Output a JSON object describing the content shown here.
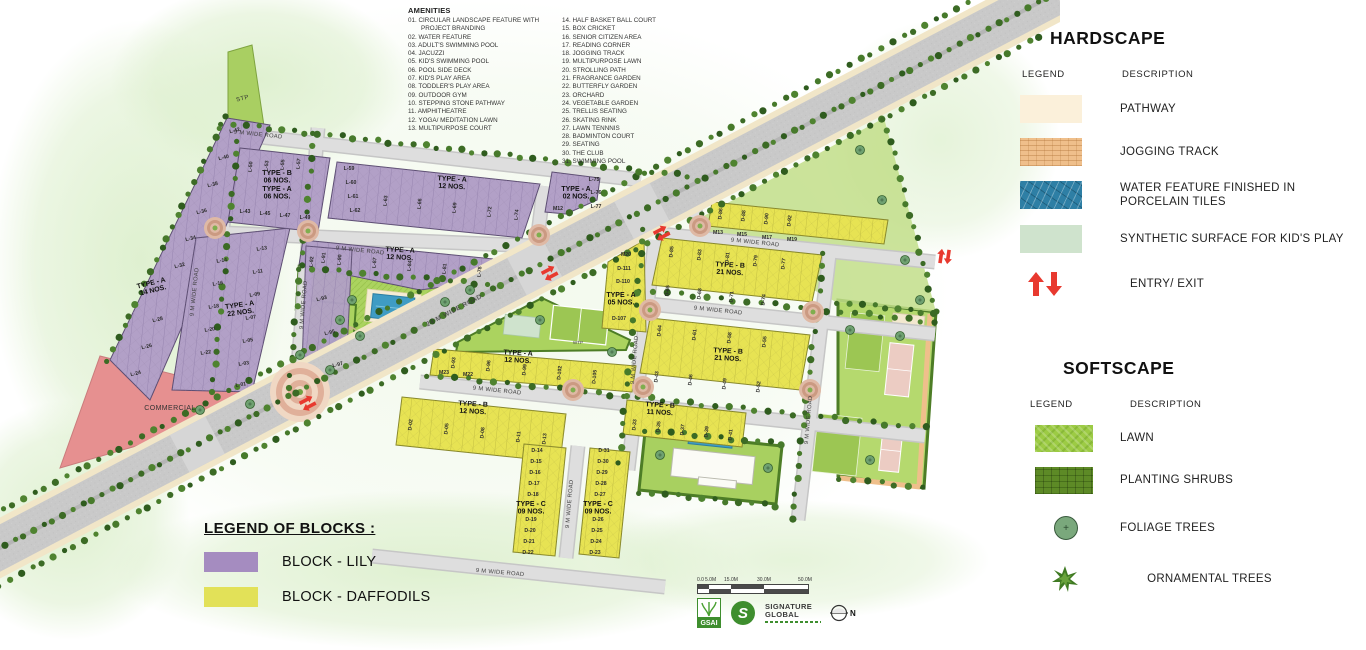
{
  "amenities": {
    "title": "AMENITIES",
    "col1": [
      "01. CIRCULAR LANDSCAPE FEATURE WITH PROJECT BRANDING",
      "02. WATER FEATURE",
      "03. ADULT'S SWIMMING POOL",
      "04. JACUZZI",
      "05. KID'S SWIMMING POOL",
      "06. POOL SIDE DECK",
      "07. KID'S PLAY AREA",
      "08. TODDLER'S PLAY AREA",
      "09. OUTDOOR GYM",
      "10. STEPPING STONE PATHWAY",
      "11. AMPHITHEATRE",
      "12. YOGA/ MEDITATION LAWN",
      "13. MULTIPURPOSE COURT"
    ],
    "col2": [
      "14. HALF BASKET BALL COURT",
      "15. BOX CRICKET",
      "16. SENIOR CITIZEN AREA",
      "17. READING CORNER",
      "18. JOGGING TRACK",
      "19. MULTIPURPOSE LAWN",
      "20. STROLLING PATH",
      "21. FRAGRANCE GARDEN",
      "22. BUTTERFLY GARDEN",
      "23. ORCHARD",
      "24. VEGETABLE GARDEN",
      "25. TRELLIS SEATING",
      "26. SKATING RINK",
      "27. LAWN TENNNIS",
      "28. BADMINTON COURT",
      "29. SEATING",
      "30. THE CLUB",
      "31. SWIMMING POOL"
    ]
  },
  "hardscape": {
    "title": "HARDSCAPE",
    "legend_header": "LEGEND",
    "description_header": "DESCRIPTION",
    "items": [
      {
        "label": "PATHWAY",
        "color": "#fbf0da"
      },
      {
        "label": "JOGGING TRACK",
        "color": "#efbf8b"
      },
      {
        "label": "WATER FEATURE FINISHED IN PORCELAIN TILES",
        "color": "#2e7fa5"
      },
      {
        "label": "SYNTHETIC SURFACE FOR KID'S PLAY",
        "color": "#cfe3cd"
      },
      {
        "label": "ENTRY/ EXIT",
        "color": "#e8392f"
      }
    ]
  },
  "softscape": {
    "title": "SOFTSCAPE",
    "legend_header": "LEGEND",
    "description_header": "DESCRIPTION",
    "items": [
      {
        "label": "LAWN",
        "color": "#9ccb44"
      },
      {
        "label": "PLANTING SHRUBS",
        "color": "#5d8a26"
      },
      {
        "label": "FOLIAGE TREES",
        "color": "#7aa87c"
      },
      {
        "label": "ORNAMENTAL TREES",
        "color": "#3f7a22"
      }
    ]
  },
  "blocks_legend": {
    "title": "LEGEND OF BLOCKS :",
    "items": [
      {
        "label": "BLOCK - LILY",
        "color": "#a58cc0"
      },
      {
        "label": "BLOCK - DAFFODILS",
        "color": "#e2e158"
      }
    ]
  },
  "map": {
    "stp": "STP",
    "commercial": "COMMERCIAL",
    "wtp": "WTP",
    "main_road": "24 M WIDE ROAD",
    "road": "9 M WIDE ROAD",
    "block_labels": [
      {
        "t": "TYPE - A",
        "n": "14 NOS."
      },
      {
        "t": "TYPE - A",
        "n": "22 NOS."
      },
      {
        "t": "TYPE - B",
        "n": "06 NOS."
      },
      {
        "t": "TYPE - A",
        "n": "06 NOS."
      },
      {
        "t": "TYPE - A",
        "n": "12 NOS."
      },
      {
        "t": "TYPE - A",
        "n": "12 NOS."
      },
      {
        "t": "TYPE - A",
        "n": "02 NOS."
      },
      {
        "t": "TYPE - B",
        "n": "21 NOS."
      },
      {
        "t": "TYPE - B",
        "n": "21 NOS."
      },
      {
        "t": "TYPE - A",
        "n": "12 NOS."
      },
      {
        "t": "TYPE - A",
        "n": "05 NOS."
      },
      {
        "t": "TYPE - B",
        "n": "12 NOS."
      },
      {
        "t": "TYPE - C",
        "n": "09 NOS."
      },
      {
        "t": "TYPE - C",
        "n": "09 NOS."
      },
      {
        "t": "TYPE - B",
        "n": "11 NOS."
      }
    ],
    "plot_labels": [
      "L-42",
      "L-40",
      "L-38",
      "L-36",
      "L-34",
      "L-32",
      "L-28",
      "L-26",
      "L-24",
      "L-13",
      "L-11",
      "L-09",
      "L-07",
      "L-05",
      "L-03",
      "L-01",
      "L-14",
      "L-16",
      "L-18",
      "L-20",
      "L-22",
      "L-50",
      "L-53",
      "L-55",
      "L-57",
      "L-43",
      "L-45",
      "L-47",
      "L-49",
      "L-59",
      "L-60",
      "L-61",
      "L-62",
      "L-63",
      "L-66",
      "L-69",
      "L-72",
      "L-74",
      "L-91",
      "L-90",
      "L-87",
      "L-84",
      "L-81",
      "L-78",
      "L-92",
      "L-93",
      "L-95",
      "L-97",
      "L-75",
      "L-76",
      "L-77",
      "M12",
      "D-86",
      "D-88",
      "D-90",
      "D-92",
      "M13",
      "M15",
      "M17",
      "M19",
      "D-85",
      "D-83",
      "D-81",
      "D-79",
      "D-77",
      "D-65",
      "D-68",
      "D-71",
      "D-74",
      "D-64",
      "D-61",
      "D-58",
      "D-55",
      "D-43",
      "D-46",
      "D-49",
      "D-52",
      "M20",
      "D-111",
      "D-110",
      "D-107",
      "M23",
      "M22",
      "D-93",
      "D-96",
      "D-99",
      "D-102",
      "D-105",
      "D-02",
      "D-05",
      "D-08",
      "D-11",
      "D-13",
      "D-14",
      "D-15",
      "D-16",
      "D-17",
      "D-18",
      "D-19",
      "D-20",
      "D-21",
      "D-22",
      "D-31",
      "D-30",
      "D-29",
      "D-28",
      "D-27",
      "D-26",
      "D-25",
      "D-24",
      "D-23",
      "D-33",
      "D-35",
      "D-37",
      "D-39",
      "D-41"
    ]
  },
  "scale_bar": {
    "labels": [
      "0.0",
      "5.0M",
      "15.0M",
      "30.0M",
      "50.0M"
    ]
  },
  "logos": {
    "gsai": "GSAI",
    "brand1": "SIGNATURE",
    "brand2": "GLOBAL",
    "north": "N"
  }
}
